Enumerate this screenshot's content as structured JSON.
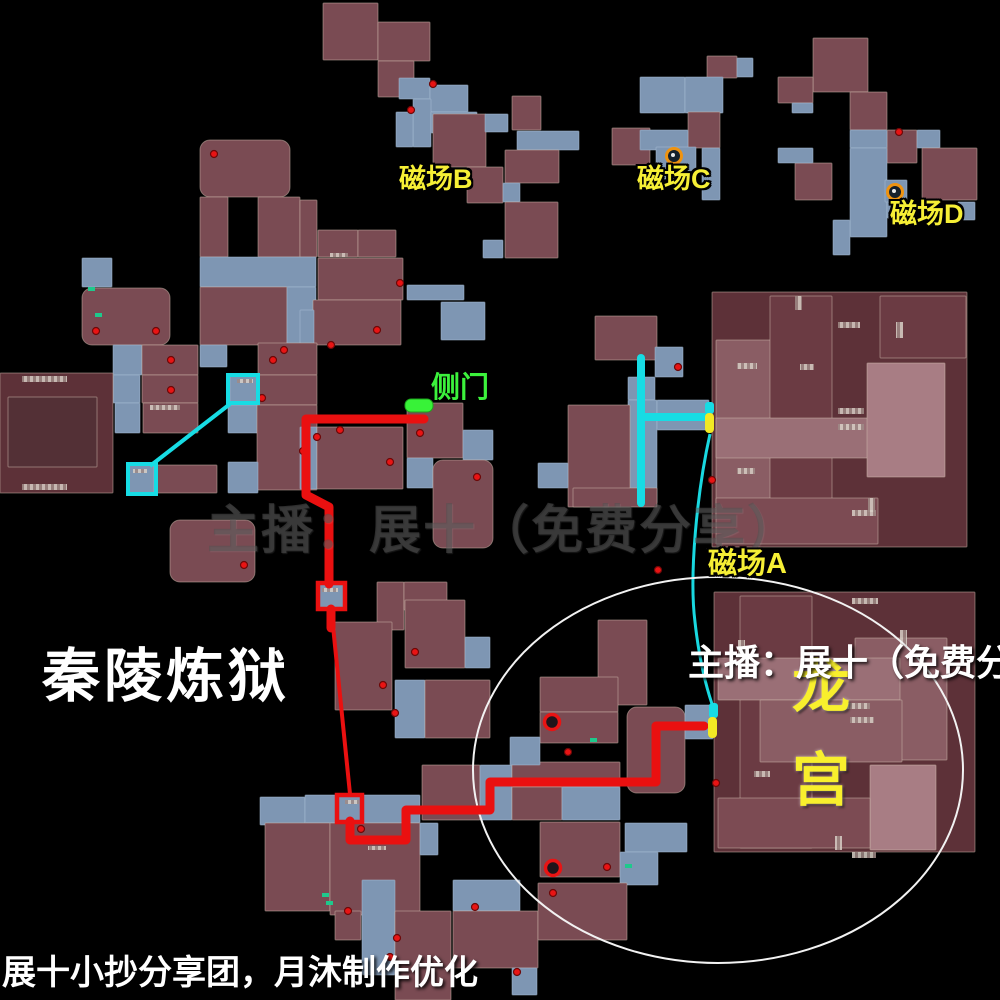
{
  "canvas": {
    "w": 1000,
    "h": 1000,
    "bg": "#000000"
  },
  "labels": {
    "title": "秦陵炼狱",
    "credit": "展十小抄分享团，月沐制作优化",
    "watermark": "主播：展十（免费分享）",
    "side_door": "侧门",
    "dragon_palace": "龙宫",
    "field_a": "磁场A",
    "field_b": "磁场B",
    "field_c": "磁场C",
    "field_d": "磁场D"
  },
  "colors": {
    "background": "#000000",
    "room_maroon": "#7a4b53",
    "building_dark": "#5d3138",
    "corridor_blue": "#7e96b3",
    "route_red": "#ea1010",
    "route_cyan": "#17dce4",
    "marker_yellow": "#f2e924",
    "door_green": "#38f238",
    "label_yellow": "#f6ef35",
    "icon_orange": "#ef9310",
    "ellipse_white": "#f2f2f2"
  },
  "map": {
    "palette": {
      "R": "#7a4b53",
      "D": "#5d3138",
      "B": "#7e96b3",
      "G": "#8a5d64",
      "L": "#9a6f76",
      "X": "#a87d84",
      "E": "#6b3b43",
      "I": "#533036",
      "C": "#7c4b53"
    },
    "rooms": [
      [
        323,
        3,
        55,
        57,
        "R"
      ],
      [
        378,
        22,
        52,
        39,
        "R"
      ],
      [
        378,
        61,
        36,
        36,
        "R"
      ],
      [
        399,
        78,
        31,
        21,
        "B"
      ],
      [
        430,
        85,
        38,
        27,
        "B"
      ],
      [
        413,
        99,
        18,
        48,
        "B"
      ],
      [
        431,
        112,
        46,
        21,
        "B"
      ],
      [
        396,
        112,
        17,
        35,
        "B"
      ],
      [
        455,
        115,
        23,
        17,
        "B"
      ],
      [
        433,
        114,
        53,
        53,
        "R"
      ],
      [
        467,
        167,
        36,
        36,
        "R"
      ],
      [
        485,
        114,
        23,
        18,
        "B"
      ],
      [
        512,
        96,
        29,
        34,
        "R"
      ],
      [
        517,
        131,
        62,
        19,
        "B"
      ],
      [
        505,
        150,
        54,
        33,
        "R"
      ],
      [
        503,
        183,
        17,
        19,
        "B"
      ],
      [
        505,
        202,
        53,
        56,
        "R"
      ],
      [
        483,
        240,
        20,
        18,
        "B"
      ],
      [
        707,
        56,
        30,
        22,
        "R"
      ],
      [
        737,
        58,
        16,
        19,
        "B"
      ],
      [
        640,
        77,
        45,
        36,
        "B"
      ],
      [
        685,
        77,
        38,
        36,
        "B"
      ],
      [
        612,
        128,
        38,
        37,
        "R"
      ],
      [
        688,
        112,
        32,
        36,
        "R"
      ],
      [
        640,
        130,
        48,
        20,
        "B"
      ],
      [
        656,
        147,
        40,
        32,
        "B"
      ],
      [
        702,
        148,
        18,
        52,
        "B"
      ],
      [
        813,
        38,
        55,
        54,
        "R"
      ],
      [
        778,
        77,
        35,
        26,
        "R"
      ],
      [
        792,
        103,
        21,
        10,
        "B"
      ],
      [
        850,
        92,
        37,
        38,
        "R"
      ],
      [
        887,
        130,
        30,
        33,
        "R"
      ],
      [
        917,
        130,
        23,
        18,
        "B"
      ],
      [
        922,
        148,
        55,
        52,
        "R"
      ],
      [
        850,
        130,
        37,
        18,
        "B"
      ],
      [
        850,
        148,
        37,
        89,
        "B"
      ],
      [
        795,
        163,
        37,
        37,
        "R"
      ],
      [
        778,
        148,
        35,
        15,
        "B"
      ],
      [
        885,
        180,
        22,
        22,
        "B"
      ],
      [
        958,
        202,
        17,
        18,
        "B"
      ],
      [
        833,
        220,
        17,
        35,
        "B"
      ],
      [
        887,
        202,
        18,
        16,
        "B"
      ],
      [
        200,
        140,
        90,
        57,
        "R",
        10
      ],
      [
        200,
        197,
        28,
        60,
        "R"
      ],
      [
        258,
        197,
        42,
        60,
        "R"
      ],
      [
        300,
        200,
        17,
        57,
        "R"
      ],
      [
        200,
        257,
        116,
        30,
        "B"
      ],
      [
        82,
        258,
        30,
        29,
        "B"
      ],
      [
        82,
        288,
        88,
        57,
        "R",
        10
      ],
      [
        200,
        287,
        87,
        58,
        "R"
      ],
      [
        287,
        287,
        29,
        63,
        "B"
      ],
      [
        318,
        230,
        40,
        27,
        "R"
      ],
      [
        358,
        230,
        38,
        27,
        "R"
      ],
      [
        318,
        258,
        85,
        42,
        "R"
      ],
      [
        407,
        285,
        57,
        15,
        "B"
      ],
      [
        313,
        300,
        88,
        45,
        "R"
      ],
      [
        300,
        310,
        14,
        35,
        "B"
      ],
      [
        441,
        302,
        44,
        38,
        "B"
      ],
      [
        113,
        345,
        29,
        30,
        "B"
      ],
      [
        142,
        345,
        56,
        30,
        "R"
      ],
      [
        113,
        375,
        27,
        28,
        "B"
      ],
      [
        142,
        375,
        56,
        28,
        "R"
      ],
      [
        115,
        403,
        25,
        30,
        "B"
      ],
      [
        143,
        403,
        55,
        30,
        "R"
      ],
      [
        200,
        345,
        27,
        22,
        "B"
      ],
      [
        258,
        343,
        59,
        32,
        "R"
      ],
      [
        230,
        375,
        28,
        28,
        "B"
      ],
      [
        228,
        405,
        30,
        28,
        "B"
      ],
      [
        258,
        375,
        59,
        30,
        "R"
      ],
      [
        257,
        405,
        60,
        85,
        "R"
      ],
      [
        228,
        462,
        30,
        31,
        "B"
      ],
      [
        155,
        465,
        62,
        28,
        "R"
      ],
      [
        128,
        464,
        26,
        29,
        "B"
      ],
      [
        0,
        373,
        113,
        120,
        "D"
      ],
      [
        8,
        397,
        89,
        70,
        "I"
      ],
      [
        170,
        520,
        85,
        62,
        "R",
        10
      ],
      [
        300,
        427,
        17,
        62,
        "B"
      ],
      [
        317,
        427,
        86,
        62,
        "R"
      ],
      [
        407,
        403,
        56,
        55,
        "R"
      ],
      [
        463,
        430,
        30,
        30,
        "B"
      ],
      [
        407,
        458,
        26,
        30,
        "B"
      ],
      [
        433,
        460,
        60,
        88,
        "R",
        10
      ],
      [
        318,
        583,
        27,
        26,
        "B"
      ],
      [
        377,
        582,
        27,
        48,
        "R"
      ],
      [
        404,
        582,
        43,
        28,
        "R"
      ],
      [
        335,
        622,
        57,
        88,
        "R"
      ],
      [
        405,
        600,
        60,
        68,
        "R"
      ],
      [
        465,
        637,
        25,
        31,
        "B"
      ],
      [
        395,
        680,
        30,
        58,
        "B"
      ],
      [
        425,
        680,
        65,
        58,
        "R"
      ],
      [
        598,
        620,
        49,
        85,
        "R"
      ],
      [
        595,
        316,
        62,
        44,
        "R"
      ],
      [
        655,
        347,
        28,
        30,
        "B"
      ],
      [
        628,
        377,
        27,
        23,
        "B"
      ],
      [
        628,
        400,
        29,
        103,
        "B"
      ],
      [
        657,
        400,
        52,
        30,
        "B"
      ],
      [
        568,
        405,
        62,
        102,
        "R"
      ],
      [
        538,
        463,
        30,
        25,
        "B"
      ],
      [
        573,
        488,
        84,
        19,
        "R"
      ],
      [
        712,
        292,
        255,
        255,
        "D"
      ],
      [
        716,
        340,
        92,
        178,
        "G"
      ],
      [
        770,
        296,
        62,
        247,
        "E"
      ],
      [
        880,
        296,
        86,
        62,
        "E"
      ],
      [
        716,
        418,
        152,
        40,
        "L"
      ],
      [
        867,
        363,
        78,
        114,
        "X"
      ],
      [
        716,
        498,
        162,
        46,
        "C"
      ],
      [
        260,
        797,
        45,
        28,
        "B"
      ],
      [
        305,
        795,
        33,
        28,
        "B"
      ],
      [
        337,
        795,
        26,
        27,
        "B"
      ],
      [
        363,
        795,
        57,
        28,
        "B"
      ],
      [
        265,
        823,
        65,
        88,
        "R"
      ],
      [
        330,
        823,
        90,
        92,
        "R"
      ],
      [
        420,
        823,
        18,
        32,
        "B"
      ],
      [
        465,
        787,
        28,
        30,
        "B"
      ],
      [
        422,
        765,
        58,
        55,
        "R"
      ],
      [
        480,
        765,
        32,
        55,
        "B"
      ],
      [
        512,
        762,
        108,
        25,
        "R"
      ],
      [
        512,
        787,
        50,
        33,
        "R"
      ],
      [
        562,
        787,
        58,
        33,
        "B"
      ],
      [
        540,
        822,
        80,
        55,
        "R"
      ],
      [
        540,
        677,
        78,
        35,
        "R"
      ],
      [
        540,
        712,
        78,
        31,
        "R"
      ],
      [
        510,
        737,
        30,
        28,
        "B"
      ],
      [
        627,
        707,
        58,
        86,
        "R",
        10
      ],
      [
        685,
        705,
        28,
        34,
        "B"
      ],
      [
        625,
        823,
        62,
        29,
        "B"
      ],
      [
        620,
        852,
        38,
        33,
        "B"
      ],
      [
        335,
        911,
        26,
        29,
        "R"
      ],
      [
        362,
        880,
        33,
        95,
        "B"
      ],
      [
        395,
        911,
        56,
        89,
        "R"
      ],
      [
        453,
        880,
        67,
        31,
        "B"
      ],
      [
        453,
        911,
        85,
        57,
        "R"
      ],
      [
        512,
        968,
        25,
        27,
        "B"
      ],
      [
        538,
        883,
        89,
        57,
        "R"
      ],
      [
        714,
        592,
        261,
        260,
        "D"
      ],
      [
        740,
        596,
        72,
        252,
        "E"
      ],
      [
        855,
        638,
        92,
        122,
        "G"
      ],
      [
        718,
        658,
        182,
        42,
        "L"
      ],
      [
        760,
        700,
        142,
        62,
        "G"
      ],
      [
        870,
        765,
        66,
        85,
        "X"
      ],
      [
        718,
        798,
        152,
        50,
        "C"
      ]
    ],
    "hatches": [
      [
        22,
        376,
        45,
        6
      ],
      [
        22,
        484,
        45,
        6
      ],
      [
        150,
        405,
        30,
        5
      ],
      [
        330,
        253,
        18,
        4
      ],
      [
        237,
        379,
        16,
        4
      ],
      [
        133,
        469,
        14,
        4
      ],
      [
        322,
        588,
        16,
        4
      ],
      [
        345,
        800,
        14,
        4
      ],
      [
        368,
        846,
        18,
        4
      ],
      [
        737,
        363,
        20,
        6
      ],
      [
        800,
        364,
        14,
        6
      ],
      [
        838,
        322,
        22,
        6
      ],
      [
        896,
        322,
        7,
        16
      ],
      [
        838,
        408,
        26,
        6
      ],
      [
        838,
        424,
        26,
        6
      ],
      [
        737,
        468,
        18,
        6
      ],
      [
        852,
        510,
        24,
        6
      ],
      [
        868,
        498,
        7,
        14
      ],
      [
        795,
        296,
        7,
        14
      ],
      [
        852,
        598,
        26,
        6
      ],
      [
        900,
        630,
        7,
        16
      ],
      [
        846,
        703,
        24,
        6
      ],
      [
        850,
        717,
        24,
        6
      ],
      [
        754,
        771,
        16,
        6
      ],
      [
        835,
        836,
        7,
        14
      ],
      [
        852,
        852,
        24,
        6
      ],
      [
        738,
        640,
        7,
        14
      ]
    ],
    "dots": [
      [
        214,
        154
      ],
      [
        433,
        84
      ],
      [
        411,
        110
      ],
      [
        400,
        283
      ],
      [
        96,
        331
      ],
      [
        156,
        331
      ],
      [
        171,
        360
      ],
      [
        171,
        390
      ],
      [
        273,
        360
      ],
      [
        284,
        350
      ],
      [
        377,
        330
      ],
      [
        331,
        345
      ],
      [
        303,
        451
      ],
      [
        317,
        437
      ],
      [
        340,
        430
      ],
      [
        390,
        462
      ],
      [
        420,
        433
      ],
      [
        477,
        477
      ],
      [
        244,
        565
      ],
      [
        262,
        398
      ],
      [
        415,
        652
      ],
      [
        395,
        713
      ],
      [
        383,
        685
      ],
      [
        361,
        829
      ],
      [
        348,
        911
      ],
      [
        397,
        938
      ],
      [
        390,
        957
      ],
      [
        475,
        907
      ],
      [
        517,
        972
      ],
      [
        553,
        893
      ],
      [
        607,
        867
      ],
      [
        568,
        752
      ],
      [
        678,
        367
      ],
      [
        716,
        783
      ],
      [
        658,
        570
      ],
      [
        899,
        132
      ],
      [
        712,
        480
      ]
    ],
    "rings": [
      [
        552,
        722
      ],
      [
        553,
        868
      ]
    ],
    "teal_marks": [
      [
        88,
        287
      ],
      [
        95,
        313
      ],
      [
        322,
        893
      ],
      [
        326,
        901
      ],
      [
        625,
        864
      ],
      [
        590,
        738
      ]
    ],
    "icons": [
      [
        674,
        156
      ],
      [
        895,
        192
      ]
    ],
    "routes": {
      "red_thick": [
        [
          [
            424,
            419
          ],
          [
            306,
            419
          ],
          [
            306,
            495
          ],
          [
            329,
            507
          ],
          [
            329,
            584
          ]
        ],
        [
          [
            331,
            609
          ],
          [
            331,
            628
          ]
        ],
        [
          [
            350,
            821
          ],
          [
            350,
            840
          ],
          [
            406,
            840
          ],
          [
            406,
            810
          ],
          [
            490,
            810
          ],
          [
            490,
            782
          ],
          [
            656,
            782
          ],
          [
            656,
            726
          ],
          [
            704,
            726
          ]
        ]
      ],
      "red_thin": [
        [
          333,
          626
        ],
        [
          350,
          794
        ]
      ],
      "cyan_thin": [
        [
          230,
          404
        ],
        [
          150,
          466
        ]
      ],
      "cyan_thick": [
        [
          [
            641,
            358
          ],
          [
            641,
            503
          ]
        ],
        [
          [
            645,
            417
          ],
          [
            707,
            417
          ]
        ]
      ],
      "cyan_curve": "M710,434 C697,492 689,575 695,622 C699,658 706,686 712,704"
    },
    "waypoints": {
      "red": [
        [
          318,
          583,
          27,
          26
        ],
        [
          337,
          795,
          25,
          27
        ]
      ],
      "cyan": [
        [
          228,
          375,
          30,
          28
        ],
        [
          128,
          464,
          28,
          30
        ]
      ]
    },
    "pickup_markers": [
      {
        "cyan": [
          705,
          402,
          9,
          12
        ],
        "yellow": [
          705,
          413,
          9,
          20
        ]
      },
      {
        "cyan": [
          709,
          703,
          9,
          15
        ],
        "yellow": [
          708,
          717,
          9,
          21
        ]
      }
    ],
    "door_pill": [
      405,
      399,
      28,
      13
    ],
    "ellipse": {
      "cx": 718,
      "cy": 770,
      "rx": 245,
      "ry": 193
    }
  }
}
